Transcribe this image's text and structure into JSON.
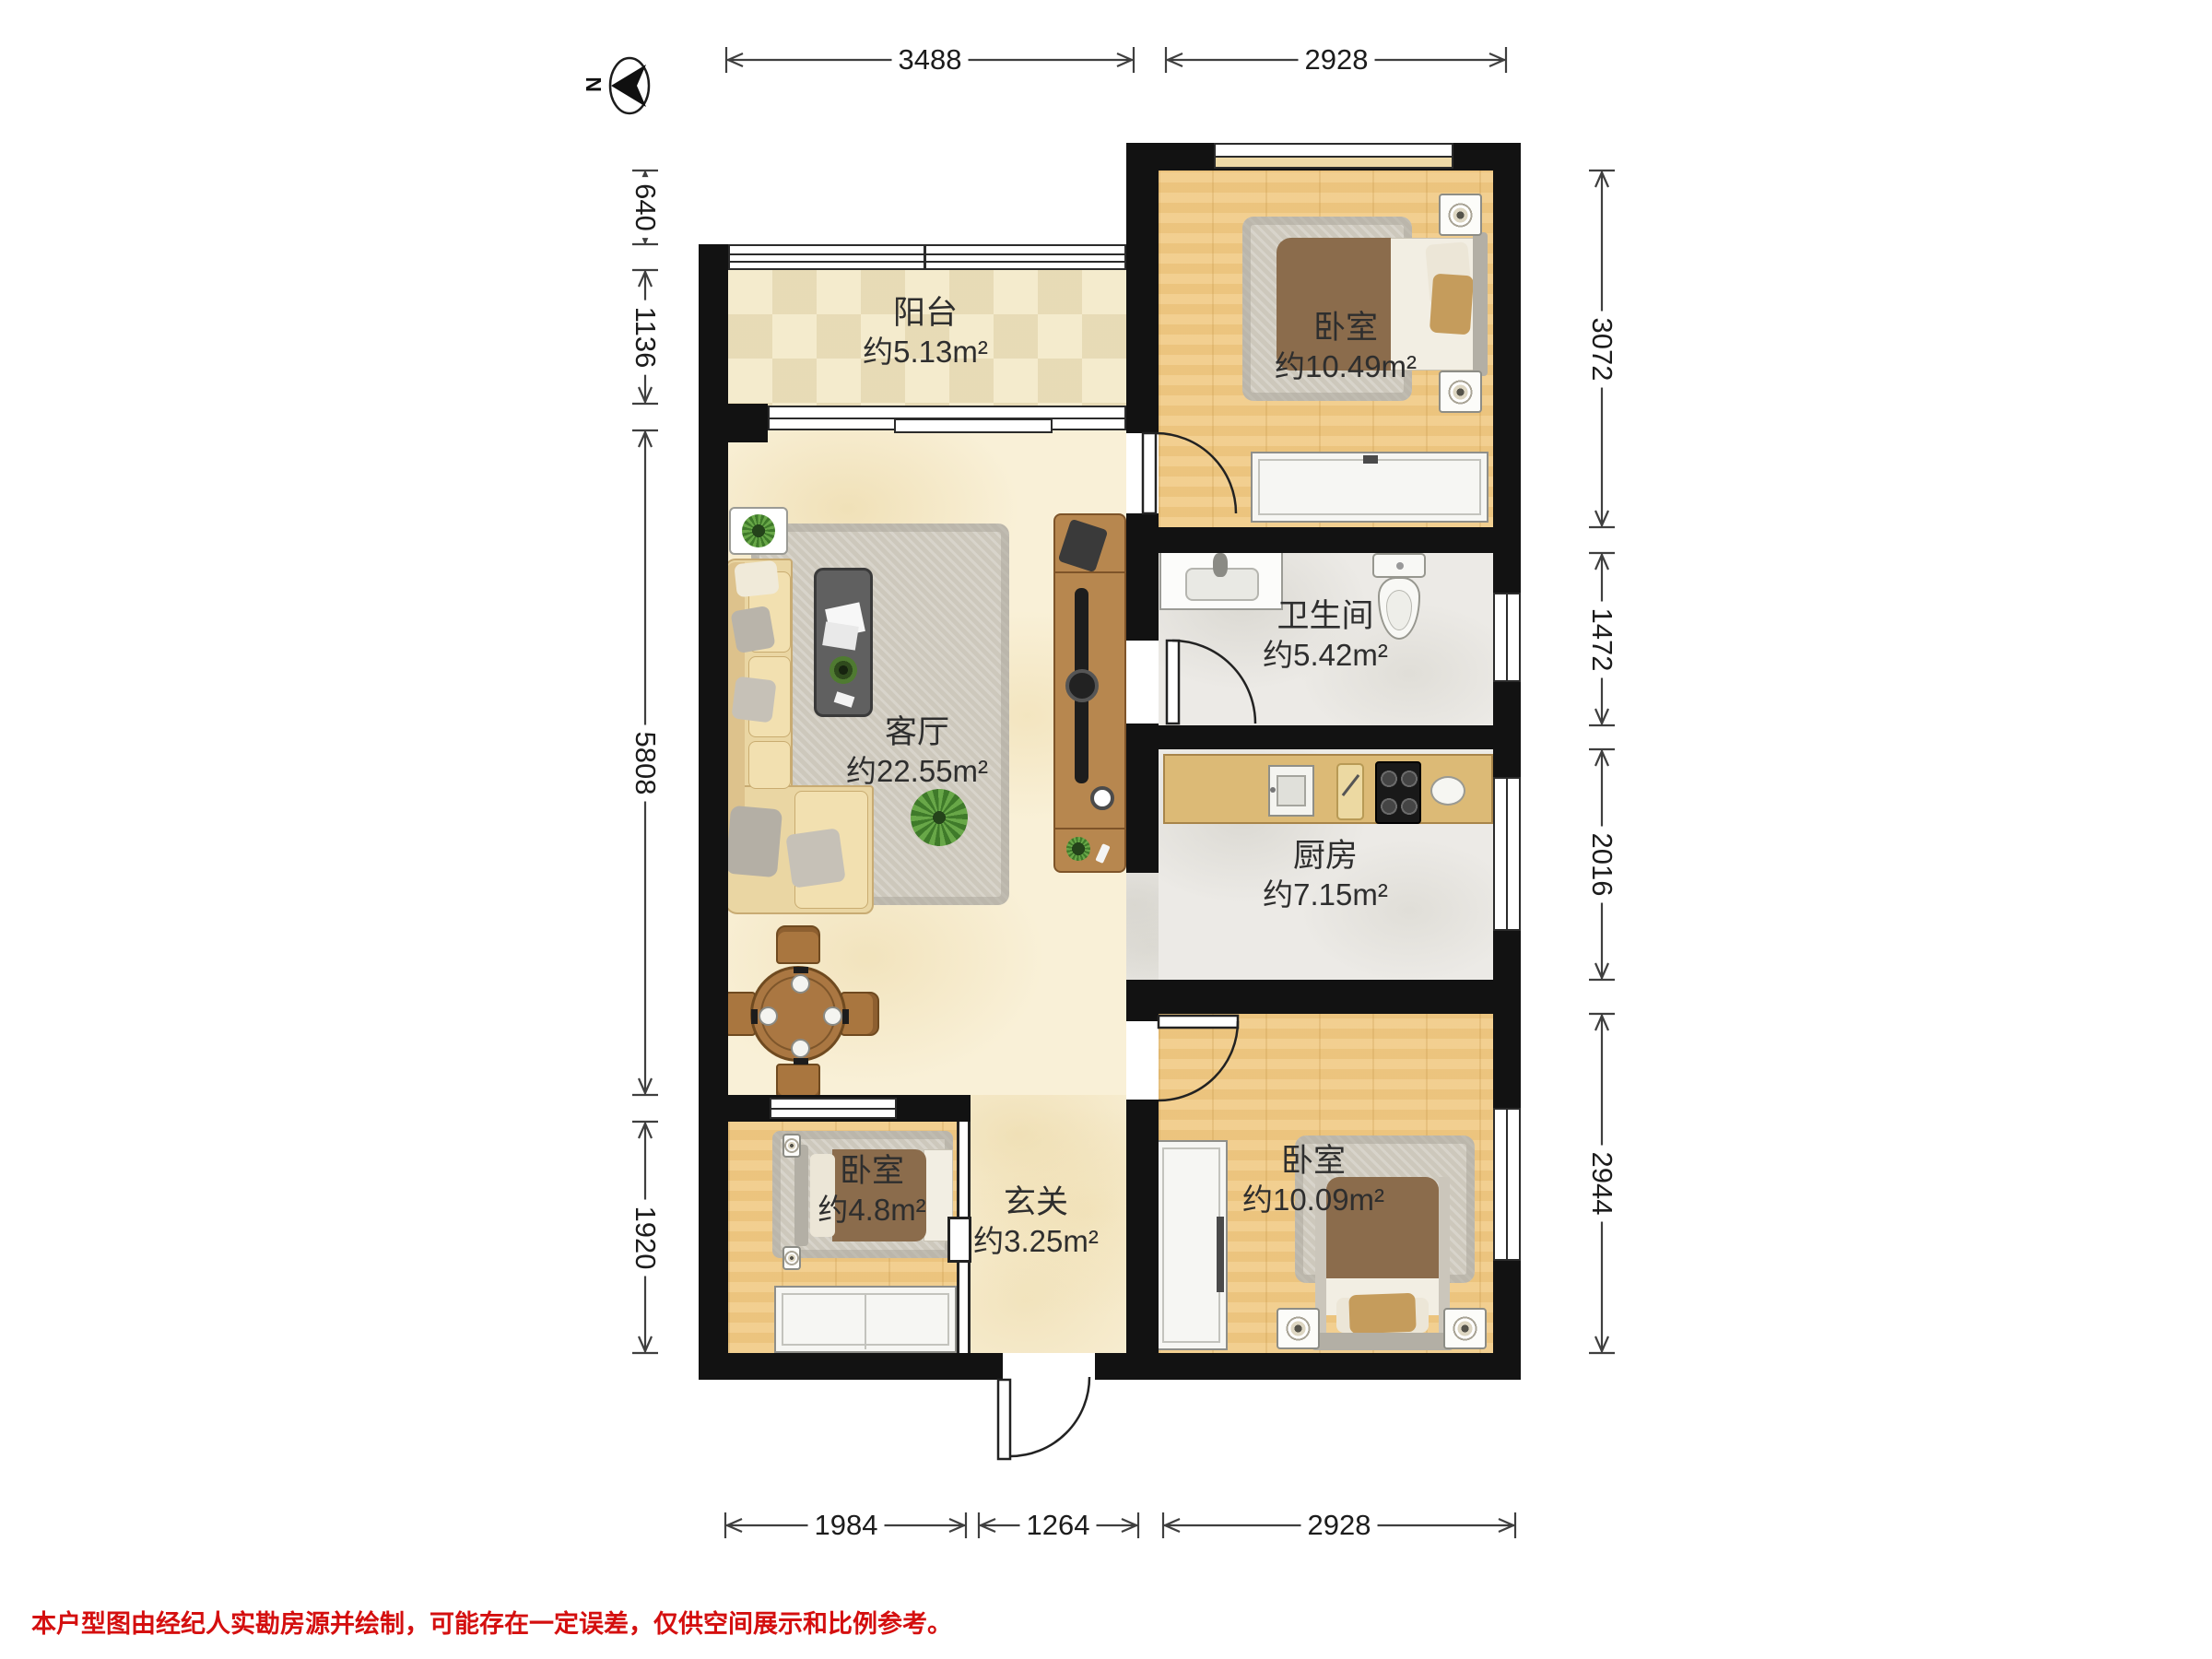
{
  "north_label": "N",
  "rooms": {
    "balcony": {
      "name": "阳台",
      "area": "约5.13m²"
    },
    "bedroom_top": {
      "name": "卧室",
      "area": "约10.49m²"
    },
    "bathroom": {
      "name": "卫生间",
      "area": "约5.42m²"
    },
    "living": {
      "name": "客厅",
      "area": "约22.55m²"
    },
    "kitchen": {
      "name": "厨房",
      "area": "约7.15m²"
    },
    "bedroom_small": {
      "name": "卧室",
      "area": "约4.8m²"
    },
    "hallway": {
      "name": "玄关",
      "area": "约3.25m²"
    },
    "bedroom_bottom": {
      "name": "卧室",
      "area": "约10.09m²"
    }
  },
  "dimensions": {
    "top": [
      "3488",
      "2928"
    ],
    "bottom": [
      "1984",
      "1264",
      "2928"
    ],
    "left": [
      "640",
      "1136",
      "5808",
      "1920"
    ],
    "right": [
      "3072",
      "1472",
      "2016",
      "2944"
    ]
  },
  "disclaimer": "本户型图由经纪人实勘房源并绘制，可能存在一定误差，仅供空间展示和比例参考。",
  "colors": {
    "wall": "#121212",
    "wood_floor": "#f1ca84",
    "marble_floor": "#f9f0d7",
    "tile_floor": "#f4ebcd",
    "stone_floor": "#eceae6",
    "kitchen_counter": "#dcba76",
    "sofa": "#ead6a3",
    "bed_blanket": "#8b6c4c",
    "tv_cabinet": "#b7874f",
    "dimension_text": "#1c1c1c",
    "disclaimer_red": "#d40f0f"
  }
}
